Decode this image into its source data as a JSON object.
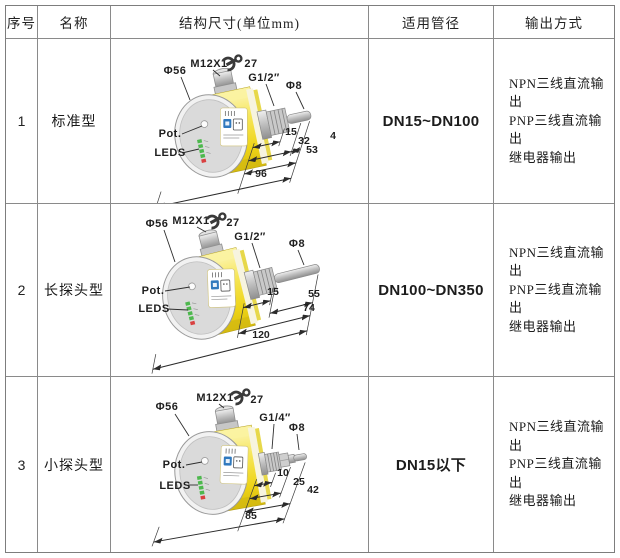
{
  "table": {
    "headers": {
      "no": "序号",
      "name": "名称",
      "structure": "结构尺寸(单位mm)",
      "pipe": "适用管径",
      "output": "输出方式"
    },
    "rows": [
      {
        "no": "1",
        "name": "标准型",
        "pipe": "DN15~DN100",
        "outputs": [
          "NPN三线直流输出",
          "PNP三线直流输出",
          "继电器输出"
        ],
        "diagram": {
          "diameter": "Φ56",
          "connector_thread": "M12X1",
          "wrench_size": "27",
          "process_thread": "G1/2″",
          "probe_diameter": "Φ8",
          "pot": "Pot.",
          "leds": "LEDS",
          "dims": {
            "d1": "15",
            "d2": "32",
            "d3": "4",
            "d4": "53",
            "d5": "96"
          }
        }
      },
      {
        "no": "2",
        "name": "长探头型",
        "pipe": "DN100~DN350",
        "outputs": [
          "NPN三线直流输出",
          "PNP三线直流输出",
          "继电器输出"
        ],
        "diagram": {
          "diameter": "Φ56",
          "connector_thread": "M12X1",
          "wrench_size": "27",
          "process_thread": "G1/2″",
          "probe_diameter": "Φ8",
          "pot": "Pot.",
          "leds": "LEDS",
          "dims": {
            "d1": "15",
            "d2": "55",
            "d3": "74",
            "d4": "120"
          }
        }
      },
      {
        "no": "3",
        "name": "小探头型",
        "pipe": "DN15以下",
        "outputs": [
          "NPN三线直流输出",
          "PNP三线直流输出",
          "继电器输出"
        ],
        "diagram": {
          "diameter": "Φ56",
          "connector_thread": "M12X1",
          "wrench_size": "27",
          "process_thread": "G1/4″",
          "probe_diameter": "Φ8",
          "pot": "Pot.",
          "leds": "LEDS",
          "dims": {
            "d1": "10",
            "d2": "25",
            "d3": "42",
            "d4": "85"
          }
        }
      }
    ],
    "colors": {
      "body_yellow": "#f2dd2e",
      "metal_grey": "#c8c8c8",
      "led_green": "#4db84d",
      "led_red": "#d94040",
      "logo_blue": "#3079be"
    }
  }
}
